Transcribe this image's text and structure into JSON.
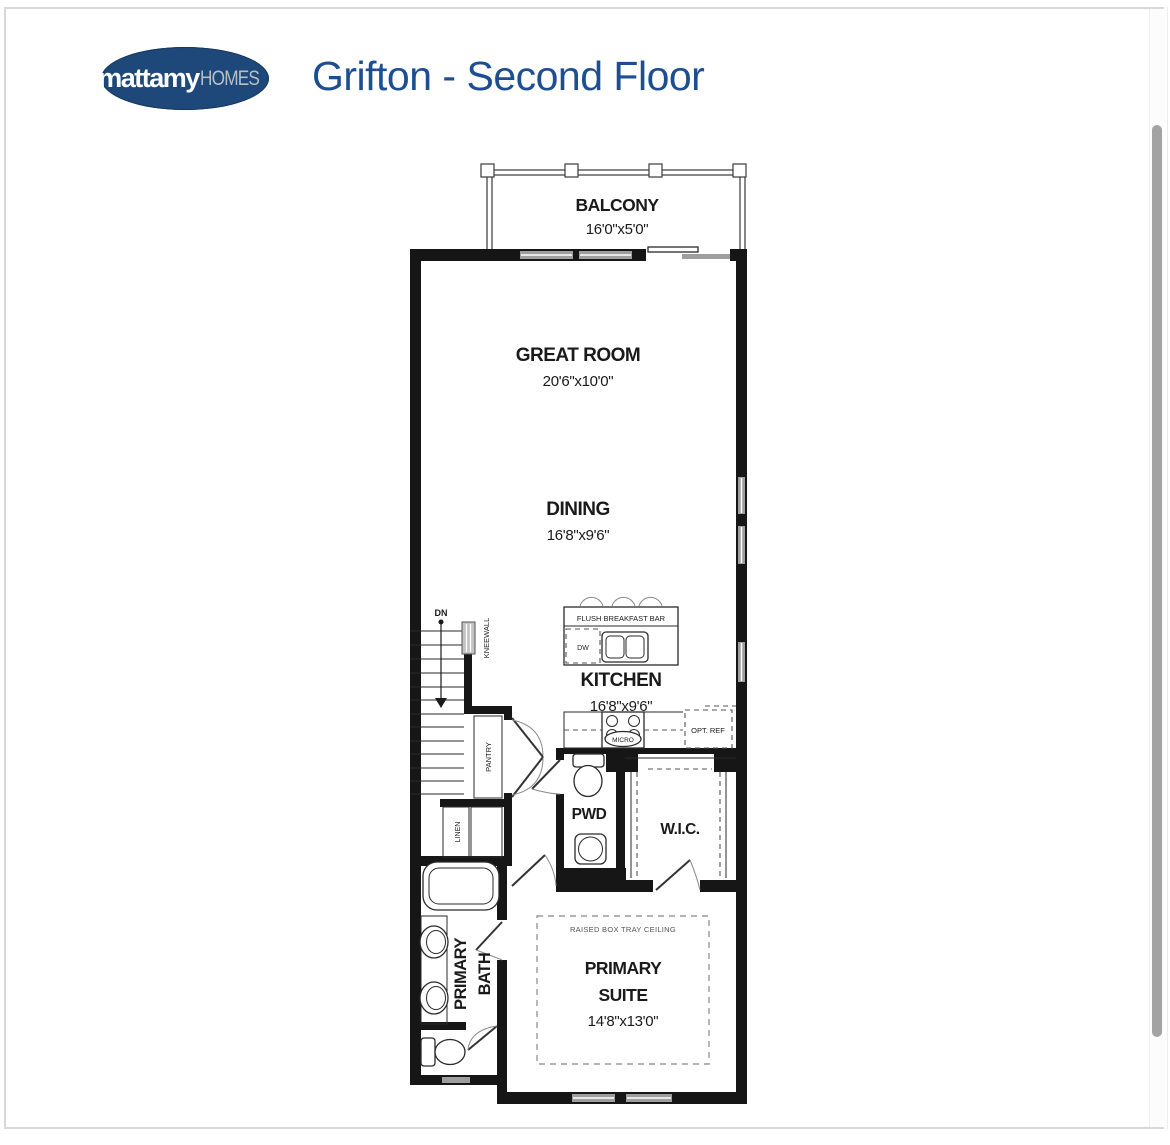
{
  "header": {
    "logo_primary": "mattamy",
    "logo_secondary": "HOMES",
    "title": "Grifton - Second Floor"
  },
  "colors": {
    "title_blue": "#1d4e91",
    "logo_navy": "#1d4879",
    "logo_silver": "#b9bec4",
    "wall_black": "#161616",
    "window_gray": "#9e9e9e",
    "scrollbar_gray": "#a3a3a3"
  },
  "plan": {
    "balcony": {
      "name": "BALCONY",
      "dims": "16'0\"x5'0\""
    },
    "great_room": {
      "name": "GREAT ROOM",
      "dims": "20'6\"x10'0\""
    },
    "dining": {
      "name": "DINING",
      "dims": "16'8\"x9'6\""
    },
    "kitchen": {
      "name": "KITCHEN",
      "dims": "16'8\"x9'6\""
    },
    "primary_suite": {
      "name_line1": "PRIMARY",
      "name_line2": "SUITE",
      "dims": "14'8\"x13'0\"",
      "ceiling_note": "RAISED BOX TRAY CEILING"
    },
    "primary_bath": {
      "name_line1": "PRIMARY",
      "name_line2": "BATH"
    },
    "pwd": {
      "name": "PWD"
    },
    "wic": {
      "name": "W.I.C."
    },
    "labels": {
      "breakfast_bar": "FLUSH BREAKFAST BAR",
      "dishwasher": "DW",
      "microwave": "MICRO",
      "opt_ref": "OPT. REF",
      "pantry": "PANTRY",
      "linen": "LINEN",
      "kneewall": "KNEEWALL",
      "stairs_down": "DN"
    }
  }
}
